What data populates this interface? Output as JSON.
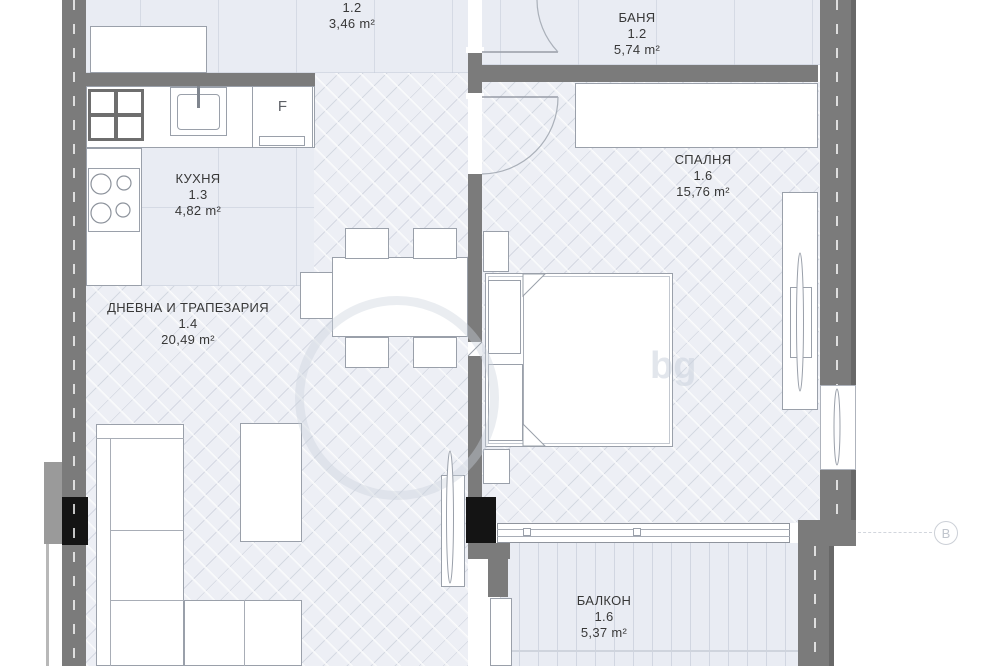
{
  "rooms": {
    "hallway": {
      "number": "1.2",
      "area": "3,46 m²"
    },
    "bathroom": {
      "name": "БАНЯ",
      "number": "1.2",
      "area": "5,74 m²"
    },
    "kitchen": {
      "name": "КУХНЯ",
      "number": "1.3",
      "area": "4,82 m²"
    },
    "bedroom": {
      "name": "СПАЛНЯ",
      "number": "1.6",
      "area": "15,76 m²"
    },
    "living": {
      "name": "ДНЕВНА И ТРАПЕЗАРИЯ",
      "number": "1.4",
      "area": "20,49 m²"
    },
    "balcony": {
      "name": "БАЛКОН",
      "number": "1.6",
      "area": "5,37 m²"
    }
  },
  "annotations": {
    "fridge_label": "F",
    "section_marker": "B",
    "watermark": "bg"
  },
  "palette": {
    "wall": "#7b7b7b",
    "column": "#141414",
    "floor_tile": "#e9ecf3",
    "floor_wood": "#edeff5",
    "furniture_outline": "#9aa0aa"
  }
}
